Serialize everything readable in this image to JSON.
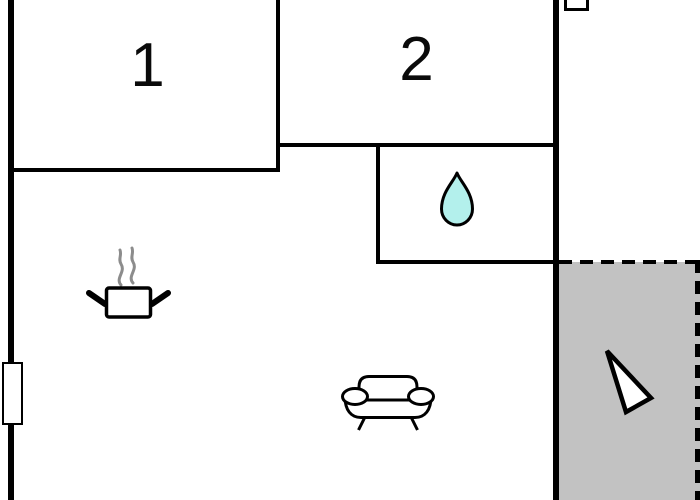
{
  "floorplan": {
    "rooms": {
      "room1": {
        "label": "1"
      },
      "room2": {
        "label": "2"
      }
    },
    "colors": {
      "background": "#ffffff",
      "wall": "#000000",
      "outline": "#000000",
      "terrace_fill": "#c2c2c2",
      "water_drop_fill": "#b3f0ec",
      "steam": "#8c8c8c",
      "fixture_fill": "#ffffff"
    },
    "icons": {
      "water_drop": "water-drop-icon",
      "cooking_pot": "cooking-pot-icon",
      "sofa": "sofa-icon",
      "north_arrow": "north-arrow-icon",
      "window": "window-icon",
      "vent": "vent-icon"
    }
  }
}
